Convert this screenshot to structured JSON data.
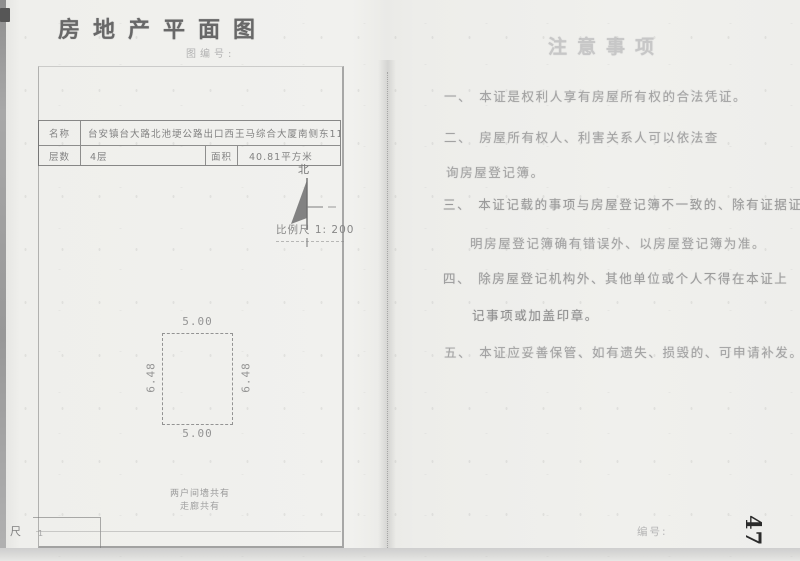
{
  "colors": {
    "ink_dark": "#2b2b2b",
    "print_faint": "#a3a3a3",
    "line_gray": "#777777"
  },
  "left_page": {
    "title": "房地产平面图",
    "subtitle": "图编号:",
    "table": {
      "name_label": "名称",
      "name_value": "台安镇台大路北池埂公路出口西王马综合大厦南侧东11间",
      "floors_label": "层数",
      "floors_value": "4层",
      "area_label": "面积",
      "area_value": "40.81平方米"
    },
    "north_label": "北",
    "scale_label": "比例尺 1: 200",
    "plan": {
      "width_top": "5.00",
      "width_bottom": "5.00",
      "height_left": "6.48",
      "height_right": "6.48"
    },
    "note_line1": "两户间墙共有",
    "note_line2": "走廊共有",
    "edge_char": "尺",
    "box_mark": "1"
  },
  "right_page": {
    "title": "注意事项",
    "items": [
      {
        "prefix": "一、",
        "line1": "本证是权利人享有房屋所有权的合法凭证。",
        "line2": ""
      },
      {
        "prefix": "二、",
        "line1": "房屋所有权人、利害关系人可以依法查",
        "line2": "询房屋登记簿。"
      },
      {
        "prefix": "三、",
        "line1": "本证记载的事项与房屋登记簿不一致的、除有证据证",
        "line2": "明房屋登记簿确有错误外、以房屋登记簿为准。"
      },
      {
        "prefix": "四、",
        "line1": "除房屋登记机构外、其他单位或个人不得在本证上",
        "line2": "记事项或加盖印章。"
      },
      {
        "prefix": "五、",
        "line1": "本证应妥善保管、如有遗失、损毁的、可申请补发。",
        "line2": ""
      }
    ],
    "serial_label": "编号:",
    "page_number": "47"
  }
}
